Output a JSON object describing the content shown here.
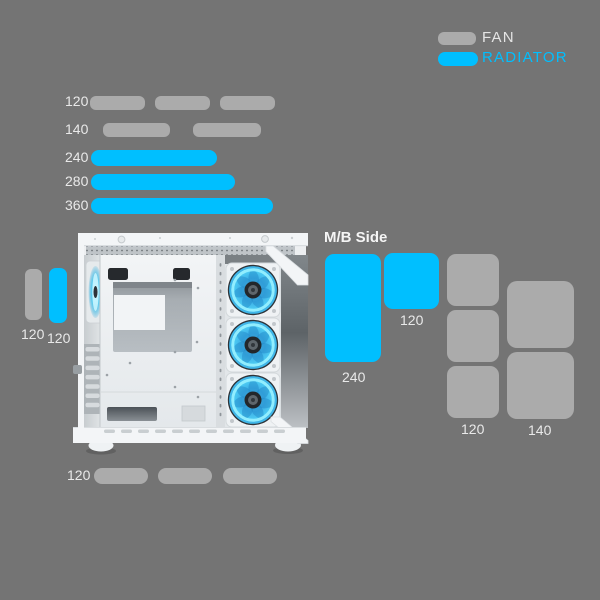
{
  "colors": {
    "background": "#747474",
    "fan_gray": "#ABABAB",
    "radiator_cyan": "#00BFFF",
    "label_text": "#E9E9E9",
    "fan_led": "#4FC8F2",
    "case_body": "#F2F4F6"
  },
  "legend": {
    "fan_label": "FAN",
    "radiator_label": "RADIATOR"
  },
  "top_mounts": {
    "rows": [
      {
        "label": "120",
        "type": "fan",
        "count": 3
      },
      {
        "label": "140",
        "type": "fan",
        "count": 2
      },
      {
        "label": "240",
        "type": "radiator",
        "count": 1
      },
      {
        "label": "280",
        "type": "radiator",
        "count": 1
      },
      {
        "label": "360",
        "type": "radiator",
        "count": 1
      }
    ]
  },
  "rear_mounts": {
    "fan_label": "120",
    "radiator_label": "120"
  },
  "mb_side_mounts": {
    "title": "M/B Side",
    "radiator_labels": [
      "240",
      "120"
    ]
  },
  "right_mounts": {
    "fan_labels": [
      "120",
      "140"
    ],
    "fan_120_count": 3,
    "fan_140_count": 2
  },
  "bottom_mounts": {
    "label": "120",
    "type": "fan",
    "count": 3
  },
  "case": {
    "front_fan_count": 3,
    "rear_fan_count": 1
  }
}
